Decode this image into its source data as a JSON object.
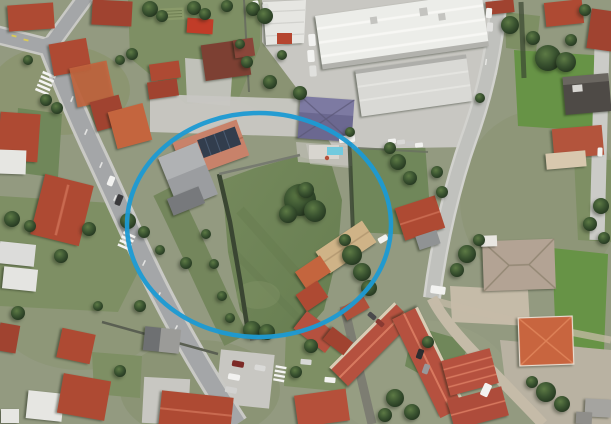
{
  "view": {
    "type": "satellite-aerial-photograph",
    "description": "Aerial satellite view of a suburban neighborhood with tile-roofed houses, an industrial warehouse, roads and a large green parcel highlighted by a blue ellipse annotation"
  },
  "annotation": {
    "shape": "ellipse",
    "cx": 259,
    "cy": 225,
    "rx": 132,
    "ry": 112,
    "stroke_color": "#1d9ad2",
    "stroke_width": 4.5
  },
  "palette": {
    "base": "#939a80",
    "field": "#7e8f64",
    "lawn": "#70875a",
    "lawn_bright": "#679346",
    "tree_dark": "#2d4226",
    "tree_light": "#5d7a45",
    "road_asphalt": "#a4a6a8",
    "road_concrete": "#c0c1bd",
    "sidewalk": "#c9c9c5",
    "gravel": "#c5bba8",
    "concrete_yard": "#c8c7c2",
    "roof_red": "#ae4a33",
    "roof_red_dark": "#a04330",
    "roof_orange": "#c4653e",
    "roof_maroon": "#7d4033",
    "roof_salmon": "#c8826a",
    "roof_tan": "#cfb387",
    "roof_slate": "#6b6890",
    "warehouse_white": "#ecede9",
    "warehouse_gray": "#d9d9d5",
    "building_white": "#e6e6e2",
    "gray_roof": "#9b9da0",
    "solar_panel": "#323d4d",
    "pool_blue": "#72cade",
    "vehicle_white": "#f2f2f0",
    "wall_dark": "#3a4632",
    "marking_white": "#f4f4f2"
  },
  "scene": {
    "features": [
      "main-diagonal-road",
      "left-cross-street",
      "top-cross-street",
      "northeast-road",
      "southeast-gravel-lane",
      "right-edge-road",
      "zebra-crossings",
      "lane-markings",
      "industrial-warehouse",
      "warehouse-yard",
      "parked-trucks",
      "solar-panel-house",
      "gray-workshop-hall",
      "slate-roof-house-with-pool",
      "central-lawn-parcel",
      "central-tree-cluster",
      "boundary-hedge-wall",
      "tan-roof-building",
      "red-tile-houses",
      "maroon-roof-house",
      "large-tan-house",
      "salmon-hip-roof-house",
      "apartment-blocks",
      "vegetable-garden",
      "parking-area-with-cars",
      "tree-clusters",
      "highlight-ellipse"
    ]
  }
}
